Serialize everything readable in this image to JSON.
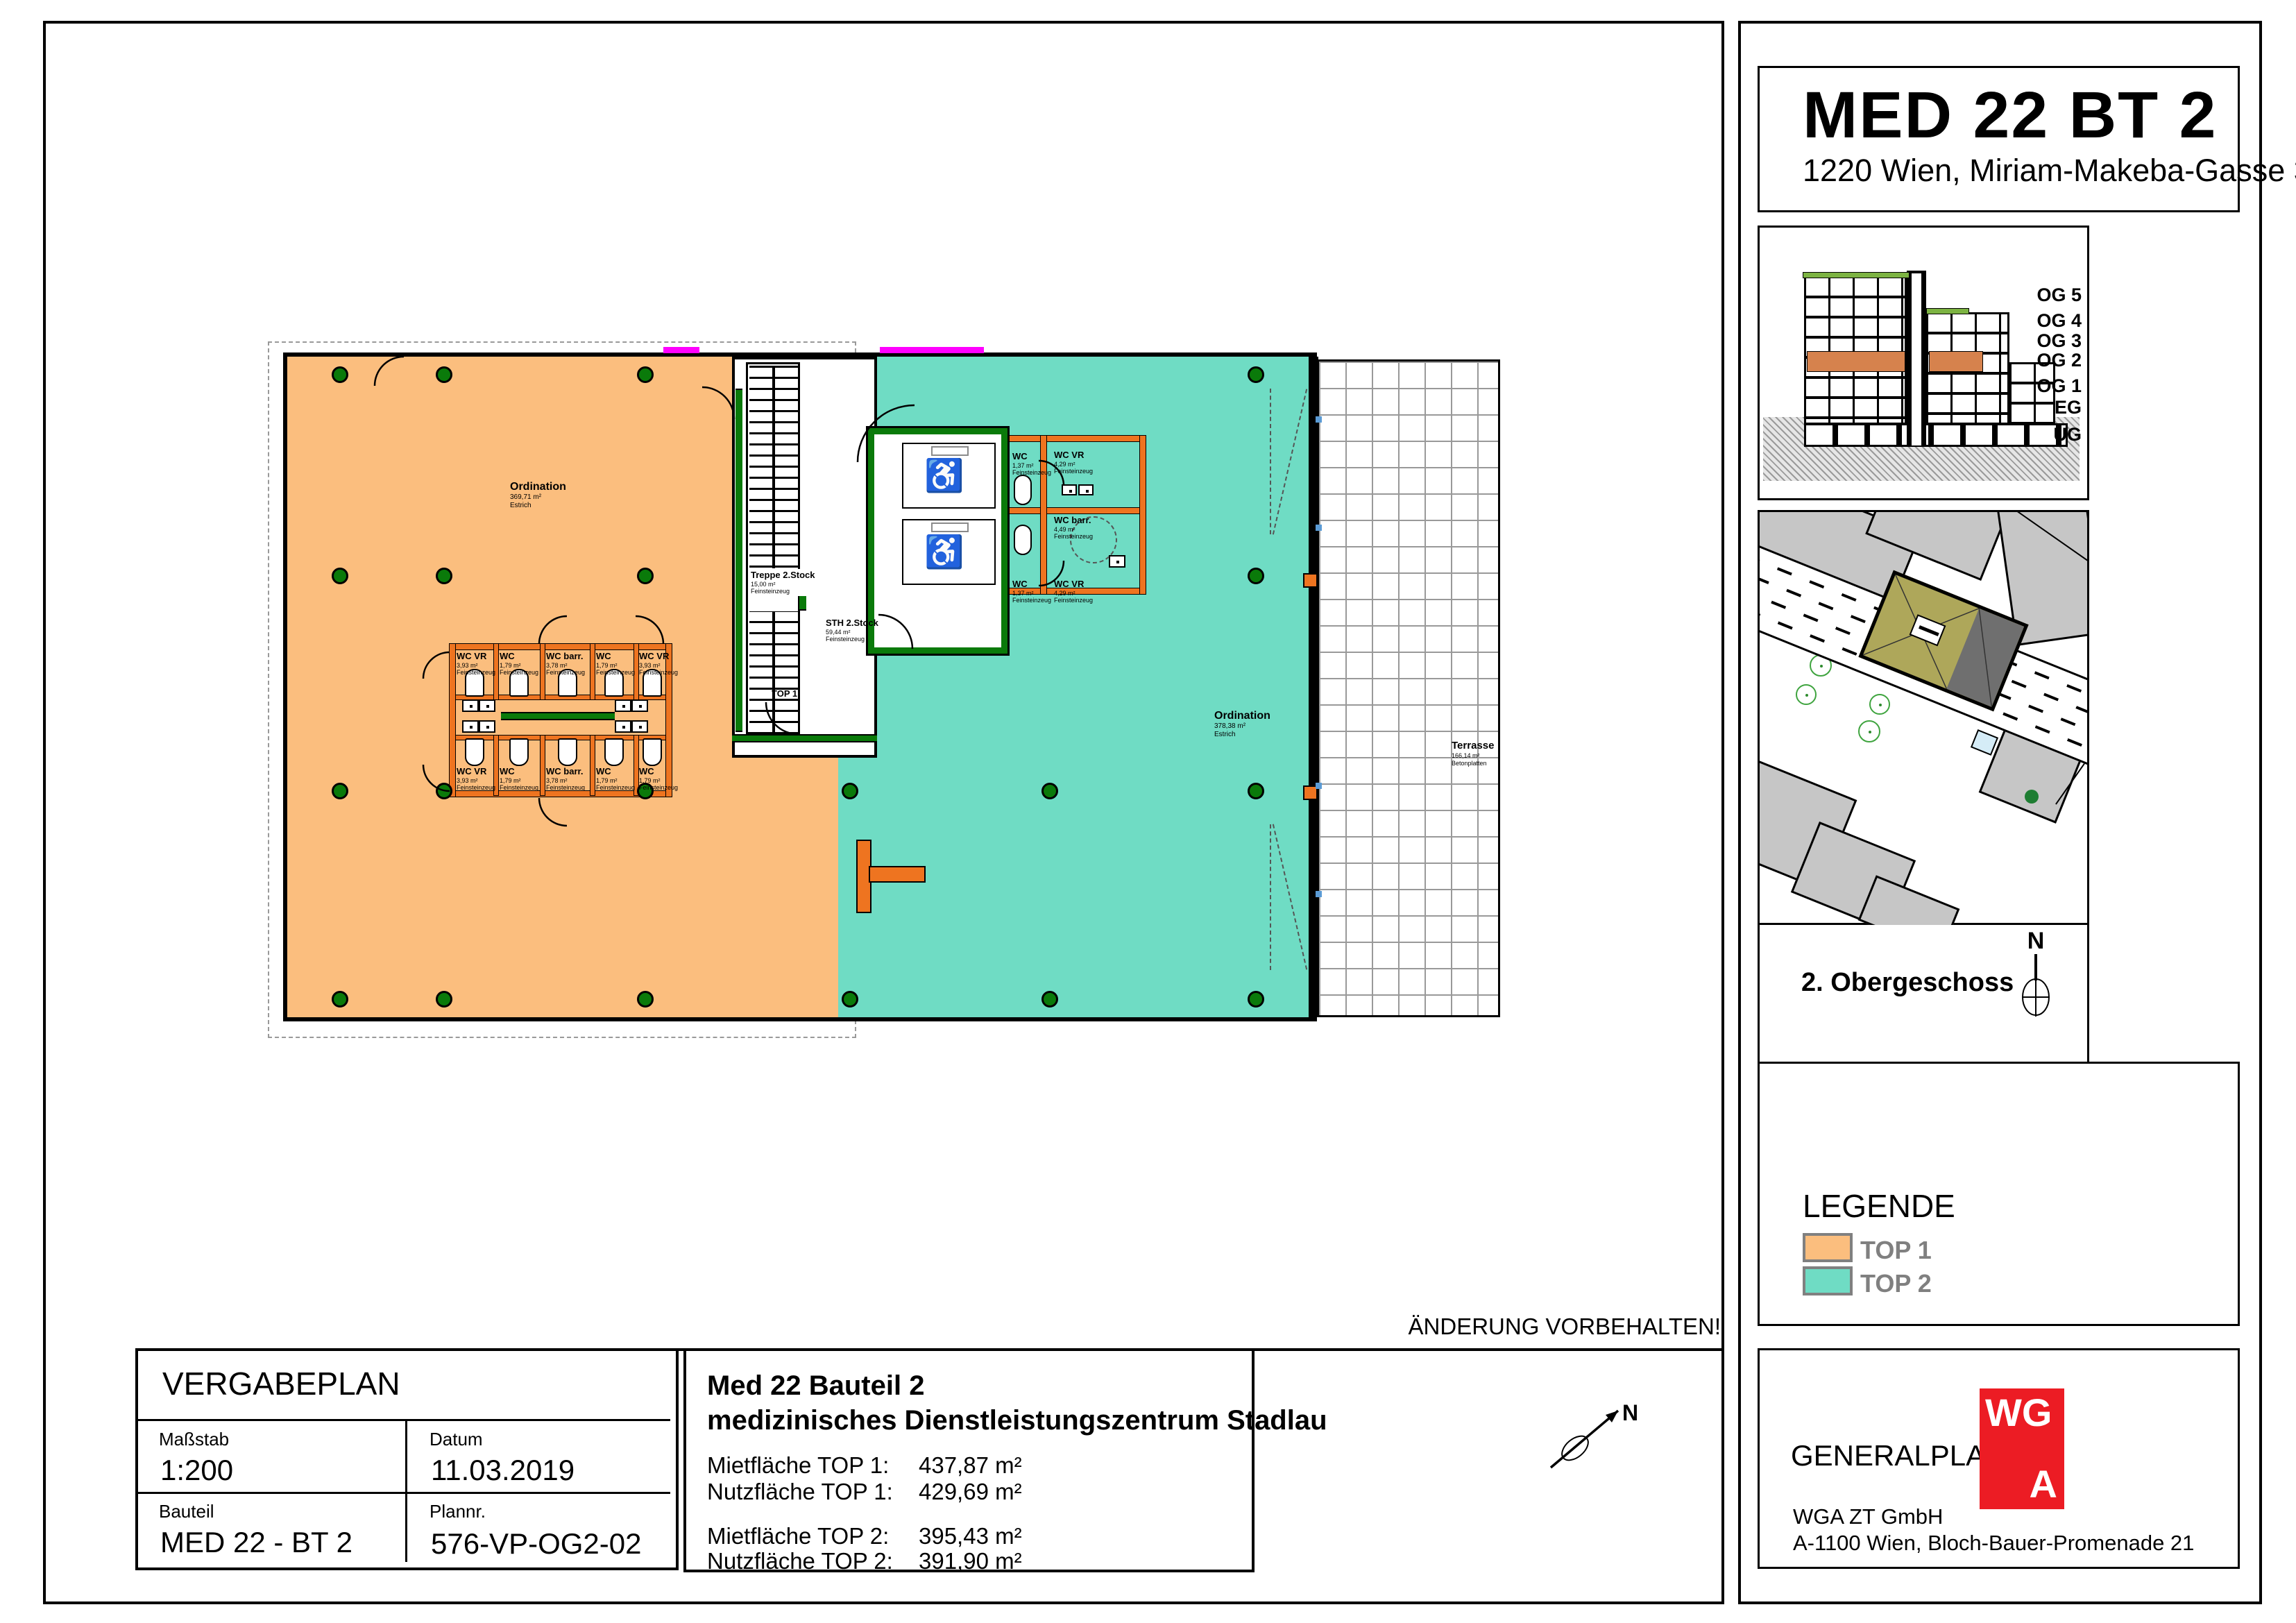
{
  "plan_note": "ÄNDERUNG VORBEHALTEN!",
  "north_label": "N",
  "titleblock": {
    "header": "VERGABEPLAN",
    "massstab_label": "Maßstab",
    "massstab_value": "1:200",
    "datum_label": "Datum",
    "datum_value": "11.03.2019",
    "bauteil_label": "Bauteil",
    "bauteil_value": "MED 22 - BT 2",
    "plannr_label": "Plannr.",
    "plannr_value": "576-VP-OG2-02"
  },
  "project": {
    "title": "Med 22 Bauteil 2",
    "subtitle": "medizinisches Dienstleistungszentrum Stadlau",
    "rows": [
      {
        "label": "Mietfläche TOP 1:",
        "value": "437,87 m²"
      },
      {
        "label": "Nutzfläche TOP 1:",
        "value": "429,69 m²"
      },
      {
        "label": "Mietfläche TOP 2:",
        "value": "395,43 m²"
      },
      {
        "label": "Nutzfläche TOP 2:",
        "value": "391,90 m²"
      }
    ]
  },
  "panel": {
    "title": "MED 22 BT 2",
    "address": "1220 Wien, Miriam-Makeba-Gasse 3",
    "floors": [
      "OG 5",
      "OG 4",
      "OG 3",
      "OG 2",
      "OG 1",
      "EG",
      "UG"
    ],
    "floor_label": "2. Obergeschoss",
    "legend": {
      "title": "LEGENDE",
      "top1": "TOP 1",
      "top2": "TOP 2"
    },
    "generalplaner": {
      "label": "GENERALPLANER:",
      "logo_line1": "WG",
      "logo_line2": "A",
      "company": "WGA ZT GmbH",
      "address": "A-1100 Wien, Bloch-Bauer-Promenade 21"
    }
  },
  "plan": {
    "top1_door": "TOP 1",
    "ordination1": {
      "name": "Ordination",
      "area": "369,71 m²",
      "material": "Estrich"
    },
    "ordination2": {
      "name": "Ordination",
      "area": "378,38 m²",
      "material": "Estrich"
    },
    "treppe": {
      "name": "Treppe 2.Stock",
      "area": "15,00 m²",
      "material": "Feinsteinzeug"
    },
    "sth": {
      "name": "STH 2.Stock",
      "area": "59,44 m²",
      "material": "Feinsteinzeug"
    },
    "terrasse": {
      "name": "Terrasse",
      "area": "166,14 m²",
      "material": "Betonplatten"
    },
    "wc_top1_row1": [
      {
        "name": "WC VR",
        "area": "3,93 m²",
        "material": "Feinsteinzeug"
      },
      {
        "name": "WC",
        "area": "1,79 m²",
        "material": "Feinsteinzeug"
      },
      {
        "name": "WC barr.",
        "area": "3,78 m²",
        "material": "Feinsteinzeug"
      },
      {
        "name": "WC",
        "area": "1,79 m²",
        "material": "Feinsteinzeug"
      },
      {
        "name": "WC VR",
        "area": "3,93 m²",
        "material": "Feinsteinzeug"
      }
    ],
    "wc_top1_row2": [
      {
        "name": "WC VR",
        "area": "3,93 m²",
        "material": "Feinsteinzeug"
      },
      {
        "name": "WC",
        "area": "1,79 m²",
        "material": "Feinsteinzeug"
      },
      {
        "name": "WC barr.",
        "area": "3,78 m²",
        "material": "Feinsteinzeug"
      },
      {
        "name": "WC",
        "area": "1,79 m²",
        "material": "Feinsteinzeug"
      },
      {
        "name": "WC",
        "area": "1,79 m²",
        "material": "Feinsteinzeug"
      }
    ],
    "wc_top2": [
      {
        "name": "WC",
        "area": "1,37 m²",
        "material": "Feinsteinzeug"
      },
      {
        "name": "WC VR",
        "area": "4,29 m²",
        "material": "Feinsteinzeug"
      },
      {
        "name": "WC barr.",
        "area": "4,49 m²",
        "material": "Feinsteinzeug"
      },
      {
        "name": "WC",
        "area": "1,37 m²",
        "material": "Feinsteinzeug"
      },
      {
        "name": "WC VR",
        "area": "4,29 m²",
        "material": "Feinsteinzeug"
      }
    ]
  },
  "colors": {
    "top1": "#FBBE7E",
    "top2": "#6FDCC4",
    "wall_orange": "#EE7420",
    "wall_green": "#0A7A0A",
    "og2_highlight": "#D6824D",
    "logo_red": "#EC1C24",
    "magenta": "#FF00FF"
  }
}
